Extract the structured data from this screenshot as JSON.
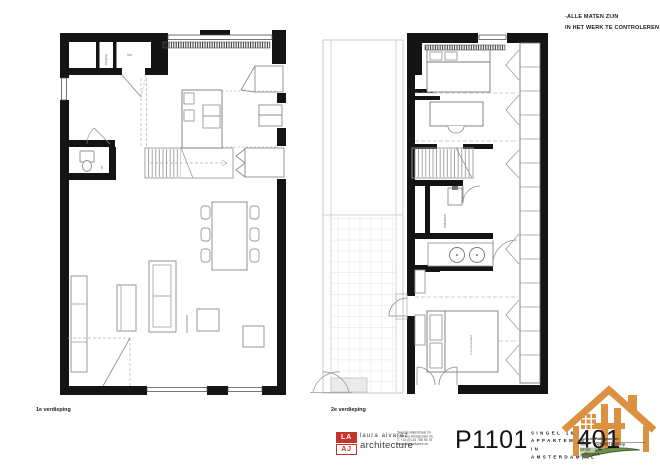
{
  "sheet": {
    "notes": [
      "-ALLE MATEN ZIJN",
      "IN HET WERK TE CONTROLEREN"
    ]
  },
  "plans": {
    "left": {
      "caption": "1e verdieping",
      "labels": {
        "storage": "berging",
        "hall": "hal",
        "wc": "wc",
        "living": "woonkamer"
      }
    },
    "right": {
      "caption": "2e verdieping",
      "labels": {
        "bathroom": "badkamer",
        "bed": "2 persoonsbed"
      }
    }
  },
  "titleblock": {
    "logo_top": "LA",
    "logo_bottom": "AJ",
    "firm_line1": "laura alvarez",
    "firm_line2": "architecture",
    "address": [
      "Tweede Atjehstraat 24",
      "1094 LG Amsterdam NL",
      "T. +31 (0) 20 758 96 76",
      "www.lauraalvarez.eu"
    ],
    "project_number": "P1101",
    "project_lines": [
      "SINGEL 16",
      "APPARTEMENT IN",
      "AMSTERDAM|NL"
    ],
    "sheet_number": "401",
    "info_rows": [
      {
        "label": "onderdeel:",
        "value": "Plattegronden"
      },
      {
        "label": "fase:",
        "value": "Definitief Ontwerp"
      },
      {
        "label": "schaal:",
        "value": "1:50"
      },
      {
        "label": "getekend:",
        "value": "LA"
      }
    ],
    "colors": {
      "accent_red": "#c8342c",
      "logo_orange": "#dc9140",
      "logo_green": "#6f8f4a"
    }
  }
}
